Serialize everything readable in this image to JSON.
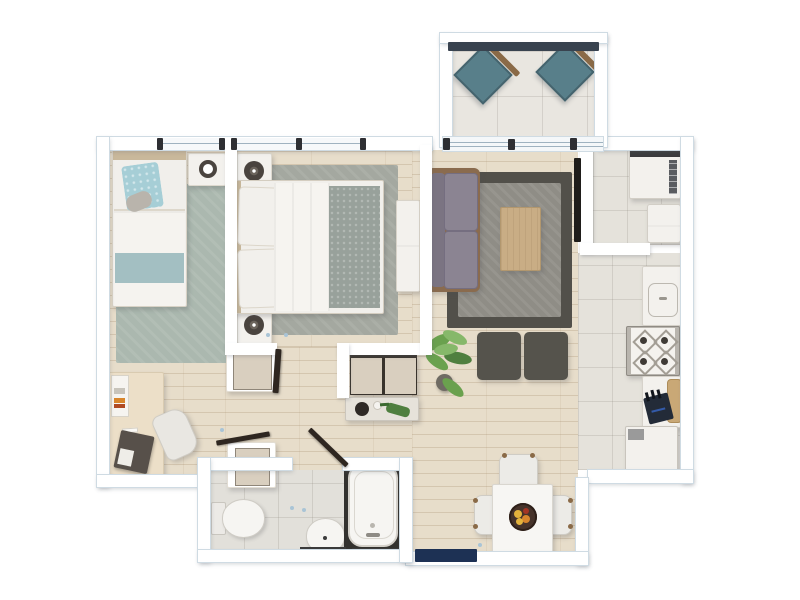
{
  "meta": {
    "title": "Apartment floor plan — top-down 3D render",
    "view": "top-down",
    "visible_text": ""
  },
  "palette": {
    "wall": "#ffffff",
    "wall-edge": "#cfdbe3",
    "wood": "#e7ddca",
    "tile": "#e5e2db",
    "balcony-tile": "#e9e6e0",
    "rug1": "#abb8af",
    "rug2": "#a4a8a0",
    "rug-liv-outer": "#52504a",
    "rug-liv-inner": "#8f8d86",
    "sofa-cushion": "#8b8492",
    "sofa-frame": "#8a6b4e",
    "coffee-table": "#c9ad85",
    "ottoman": "#55534c",
    "chair-teal": "#587f8a",
    "chair-arm": "#8a6a47",
    "rail": "#39434f",
    "linen": "#f1efeb",
    "pillow-teal": "#a6ced6",
    "band-teal": "#a3bfc2",
    "blanket-gray": "#98a19b",
    "head-wood": "#c9b89b",
    "furn-white": "#f3f1ed",
    "closet-tan": "#d9cfbf",
    "leaf": "#2e2620",
    "dark-accent": "#4a443f",
    "navy-door": "#1d3154",
    "counter-wood": "#c9a876",
    "knife": "#232b38",
    "plant-1": "#4f7f3f",
    "plant-2": "#6aa14e",
    "plant-3": "#86b86a",
    "pot": "#6f6b63",
    "bowl": "#46332a",
    "fruit-y": "#e4b33c",
    "fruit-o": "#d8862c",
    "fruit-r": "#a33524",
    "tv": "#1f1d1a",
    "mat-dark": "#3a3a3a",
    "hinge": "#a9c4d6"
  },
  "rooms": [
    {
      "name": "balcony",
      "floor": "tile",
      "furniture": [
        "outdoor-lounge-chair",
        "outdoor-lounge-chair",
        "balcony-railing",
        "sliding-door"
      ]
    },
    {
      "name": "bedroom-1",
      "floor": "wood",
      "furniture": [
        "single-bed",
        "teal-pillow",
        "nightstand",
        "alarm-clock",
        "sage-rug",
        "desk",
        "desk-chair",
        "books",
        "notebook",
        "window"
      ]
    },
    {
      "name": "bedroom-2",
      "floor": "wood",
      "furniture": [
        "double-bed",
        "gray-blanket",
        "nightstand",
        "speaker",
        "nightstand",
        "speaker",
        "gray-rug",
        "dresser",
        "window",
        "door"
      ]
    },
    {
      "name": "living-room",
      "floor": "wood",
      "furniture": [
        "sofa",
        "coffee-table",
        "two-tone-rug",
        "ottoman",
        "ottoman",
        "potted-plant",
        "wall-tv"
      ]
    },
    {
      "name": "hallway",
      "floor": "wood",
      "furniture": [
        "closet",
        "closet",
        "shoe-cabinet",
        "console-table",
        "decor-tray",
        "watering-can"
      ]
    },
    {
      "name": "bathroom",
      "floor": "tile",
      "furniture": [
        "toilet",
        "washbasin",
        "bathtub",
        "bath-mat",
        "door"
      ]
    },
    {
      "name": "kitchen",
      "floor": "tile",
      "furniture": [
        "sink-counter",
        "gas-stove",
        "prep-counter",
        "cutting-board",
        "knife-block",
        "refrigerator"
      ]
    },
    {
      "name": "laundry-room",
      "floor": "tile",
      "furniture": [
        "washing-machine",
        "laundry-basket"
      ]
    },
    {
      "name": "dining-area",
      "floor": "wood",
      "furniture": [
        "dining-table",
        "fruit-bowl",
        "dining-chair",
        "dining-chair",
        "dining-chair"
      ]
    },
    {
      "name": "entry",
      "floor": "wood",
      "furniture": [
        "front-door-mat"
      ]
    }
  ]
}
